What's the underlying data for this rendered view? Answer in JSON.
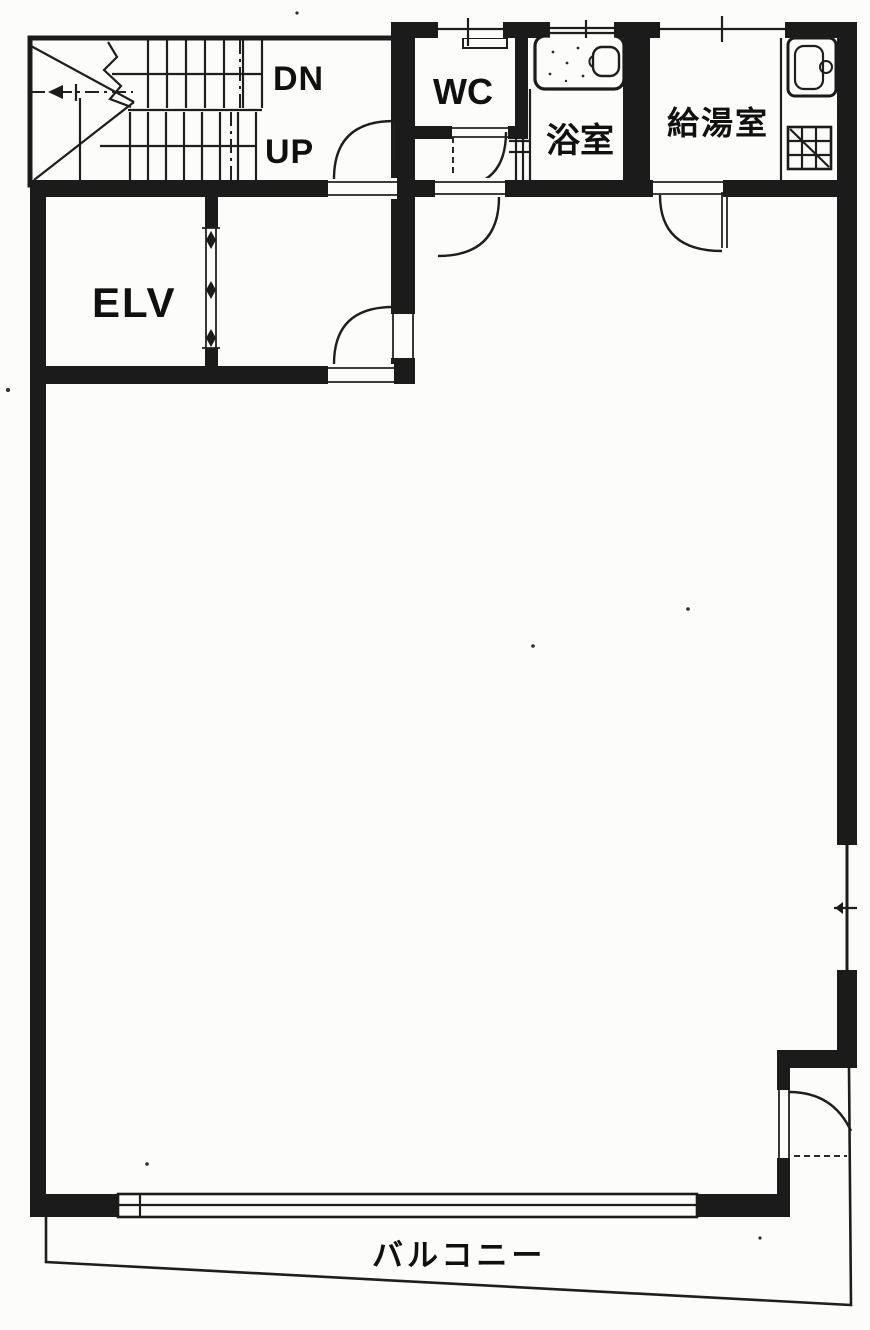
{
  "document": {
    "kind": "scanned architectural floor plan",
    "paper_color": "#fcfcfb",
    "ink_color": "#1b1b1b"
  },
  "rooms": {
    "stairs": {
      "down_label": "DN",
      "up_label": "UP"
    },
    "elevator": {
      "label": "ELV"
    },
    "toilet": {
      "label": "WC"
    },
    "bathroom": {
      "label": "浴室"
    },
    "kitchenette": {
      "label": "給湯室"
    },
    "balcony": {
      "label": "バルコニー"
    }
  },
  "icons": {
    "bathtub": "rounded-rect tub symbol",
    "kitchen_sink": "rounded-rect sink symbol",
    "stove": "hatched square burner symbol",
    "elevator_door": "diamond door-track marks",
    "stair_direction_arrow": "arrowhead on dash-dot walk line",
    "door_swing": "quarter-circle arc",
    "window": "thin double line in wall"
  }
}
